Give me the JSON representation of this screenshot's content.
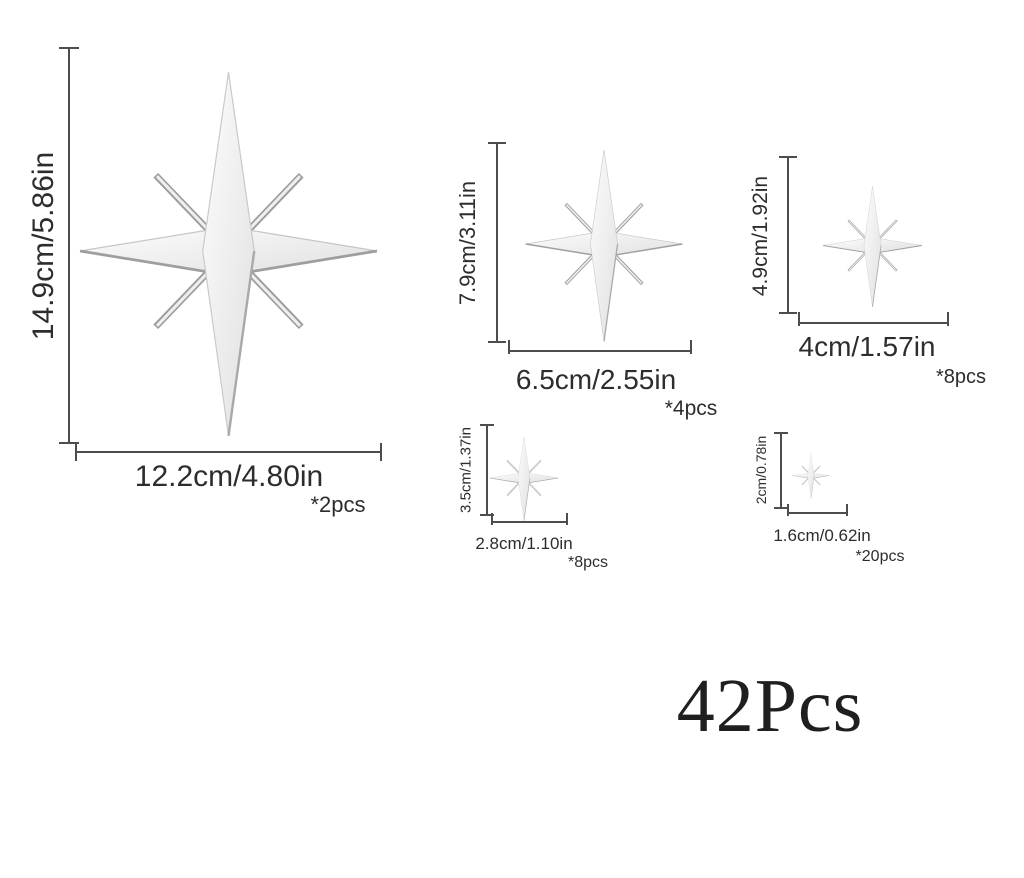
{
  "product": {
    "description": "8-point star size chart",
    "total_label": "42Pcs",
    "sizes": [
      {
        "height_label": "14.9cm/5.86in",
        "width_label": "12.2cm/4.80in",
        "count_label": "*2pcs"
      },
      {
        "height_label": "7.9cm/3.11in",
        "width_label": "6.5cm/2.55in",
        "count_label": "*4pcs"
      },
      {
        "height_label": "4.9cm/1.92in",
        "width_label": "4cm/1.57in",
        "count_label": "*8pcs"
      },
      {
        "height_label": "3.5cm/1.37in",
        "width_label": "2.8cm/1.10in",
        "count_label": "*8pcs"
      },
      {
        "height_label": "2cm/0.78in",
        "width_label": "1.6cm/0.62in",
        "count_label": "*20pcs"
      }
    ]
  },
  "colors": {
    "background": "#ffffff",
    "text": "#2d2d2d",
    "dimension_line": "#4d4d4d",
    "star_fill_light": "#fdfdfd",
    "star_fill_dark": "#e2e2e2",
    "star_edge": "#9a9a9a"
  }
}
